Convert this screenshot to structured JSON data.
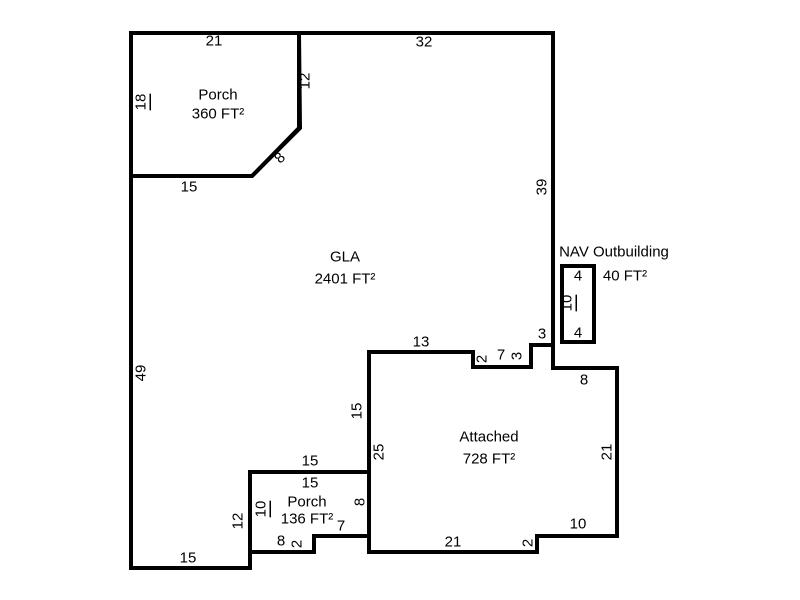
{
  "sketch": {
    "width": 800,
    "height": 600,
    "background_color": "#ffffff",
    "wall_color": "#000000",
    "wall_stroke_width": 4,
    "dim_font_size": 15,
    "area_font_size": 15,
    "scale_px_per_ft": 8,
    "shapes": [
      {
        "name": "gla-outline",
        "points": [
          [
            299,
            33
          ],
          [
            553,
            33
          ],
          [
            553,
            345
          ],
          [
            531,
            345
          ],
          [
            531,
            367
          ],
          [
            473,
            367
          ],
          [
            473,
            352
          ],
          [
            369,
            352
          ],
          [
            369,
            472
          ],
          [
            250,
            472
          ],
          [
            250,
            568
          ],
          [
            131,
            568
          ],
          [
            131,
            176
          ],
          [
            252,
            176
          ],
          [
            300,
            128
          ]
        ]
      },
      {
        "name": "porch-top-outline",
        "points": [
          [
            131,
            33
          ],
          [
            299,
            33
          ],
          [
            299,
            128
          ],
          [
            252,
            176
          ],
          [
            131,
            176
          ]
        ]
      },
      {
        "name": "attached-outline",
        "points": [
          [
            369,
            352
          ],
          [
            473,
            352
          ],
          [
            473,
            367
          ],
          [
            531,
            367
          ],
          [
            531,
            345
          ],
          [
            553,
            345
          ],
          [
            553,
            368
          ],
          [
            617,
            368
          ],
          [
            617,
            536
          ],
          [
            537,
            536
          ],
          [
            537,
            552
          ],
          [
            369,
            552
          ]
        ]
      },
      {
        "name": "porch-bottom-outline",
        "points": [
          [
            250,
            472
          ],
          [
            369,
            472
          ],
          [
            369,
            536
          ],
          [
            314,
            536
          ],
          [
            314,
            552
          ],
          [
            250,
            552
          ]
        ]
      },
      {
        "name": "outbuilding-outline",
        "points": [
          [
            562,
            266
          ],
          [
            594,
            266
          ],
          [
            594,
            342
          ],
          [
            562,
            342
          ]
        ]
      }
    ],
    "area_labels": [
      {
        "name": "label-porch-top-name",
        "text": "Porch",
        "x": 218,
        "y": 95
      },
      {
        "name": "label-porch-top-area",
        "text": "360 FT²",
        "x": 218,
        "y": 114
      },
      {
        "name": "label-gla-name",
        "text": "GLA",
        "x": 345,
        "y": 257
      },
      {
        "name": "label-gla-area",
        "text": "2401 FT²",
        "x": 345,
        "y": 279
      },
      {
        "name": "label-outbuilding-name",
        "text": "NAV Outbuilding",
        "x": 614,
        "y": 252
      },
      {
        "name": "label-outbuilding-area",
        "text": "40 FT²",
        "x": 625,
        "y": 276
      },
      {
        "name": "label-attached-name",
        "text": "Attached",
        "x": 489,
        "y": 437
      },
      {
        "name": "label-attached-area",
        "text": "728 FT²",
        "x": 489,
        "y": 459
      },
      {
        "name": "label-porch-bottom-name",
        "text": "Porch",
        "x": 307,
        "y": 502
      },
      {
        "name": "label-porch-bottom-area",
        "text": "136 FT²",
        "x": 307,
        "y": 519
      }
    ],
    "dim_labels": [
      {
        "name": "dim-porch-top-21",
        "text": "21",
        "x": 214,
        "y": 41,
        "rotate": 0,
        "underline": false
      },
      {
        "name": "dim-top-32",
        "text": "32",
        "x": 424,
        "y": 42,
        "rotate": 0,
        "underline": false
      },
      {
        "name": "dim-porch-right-12",
        "text": "12",
        "x": 305,
        "y": 81,
        "rotate": -90,
        "underline": false
      },
      {
        "name": "dim-porch-left-18",
        "text": "18",
        "x": 141,
        "y": 102,
        "rotate": -90,
        "underline": true
      },
      {
        "name": "dim-porch-diagonal-8",
        "text": "8",
        "x": 280,
        "y": 158,
        "rotate": -45,
        "underline": false
      },
      {
        "name": "dim-porch-bottom-15",
        "text": "15",
        "x": 189,
        "y": 187,
        "rotate": 0,
        "underline": false
      },
      {
        "name": "dim-right-39",
        "text": "39",
        "x": 542,
        "y": 187,
        "rotate": -90,
        "underline": false
      },
      {
        "name": "dim-left-49",
        "text": "49",
        "x": 141,
        "y": 373,
        "rotate": -90,
        "underline": false
      },
      {
        "name": "dim-outbuilding-top-4",
        "text": "4",
        "x": 578,
        "y": 276,
        "rotate": 0,
        "underline": false
      },
      {
        "name": "dim-outbuilding-side-10",
        "text": "10",
        "x": 567,
        "y": 303,
        "rotate": -90,
        "underline": true
      },
      {
        "name": "dim-outbuilding-bottom-4",
        "text": "4",
        "x": 578,
        "y": 333,
        "rotate": 0,
        "underline": false
      },
      {
        "name": "dim-gla-notch-3h",
        "text": "3",
        "x": 542,
        "y": 334,
        "rotate": 0,
        "underline": false
      },
      {
        "name": "dim-attached-top-13",
        "text": "13",
        "x": 421,
        "y": 342,
        "rotate": 0,
        "underline": false
      },
      {
        "name": "dim-attached-step-2a",
        "text": "2",
        "x": 482,
        "y": 359,
        "rotate": -90,
        "underline": false
      },
      {
        "name": "dim-attached-notch-7",
        "text": "7",
        "x": 501,
        "y": 355,
        "rotate": 0,
        "underline": false
      },
      {
        "name": "dim-gla-notch-3v",
        "text": "3",
        "x": 517,
        "y": 356,
        "rotate": -90,
        "underline": false
      },
      {
        "name": "dim-attached-top-8",
        "text": "8",
        "x": 584,
        "y": 380,
        "rotate": 0,
        "underline": false
      },
      {
        "name": "dim-gla-side-15",
        "text": "15",
        "x": 357,
        "y": 411,
        "rotate": -90,
        "underline": false
      },
      {
        "name": "dim-attached-left-25",
        "text": "25",
        "x": 379,
        "y": 452,
        "rotate": -90,
        "underline": false
      },
      {
        "name": "dim-attached-right-21",
        "text": "21",
        "x": 607,
        "y": 452,
        "rotate": -90,
        "underline": false
      },
      {
        "name": "dim-gla-bottom-15",
        "text": "15",
        "x": 310,
        "y": 461,
        "rotate": 0,
        "underline": false
      },
      {
        "name": "dim-porch-bottom-top-15",
        "text": "15",
        "x": 310,
        "y": 483,
        "rotate": 0,
        "underline": false
      },
      {
        "name": "dim-porch-bottom-left-10",
        "text": "10",
        "x": 261,
        "y": 509,
        "rotate": -90,
        "underline": true
      },
      {
        "name": "dim-gla-step-12",
        "text": "12",
        "x": 238,
        "y": 521,
        "rotate": -90,
        "underline": false
      },
      {
        "name": "dim-porch-bottom-right-8",
        "text": "8",
        "x": 360,
        "y": 502,
        "rotate": -90,
        "underline": false
      },
      {
        "name": "dim-porch-bottom-notch-7",
        "text": "7",
        "x": 341,
        "y": 526,
        "rotate": 0,
        "underline": false
      },
      {
        "name": "dim-porch-bottom-8",
        "text": "8",
        "x": 281,
        "y": 541,
        "rotate": 0,
        "underline": false
      },
      {
        "name": "dim-porch-bottom-step-2",
        "text": "2",
        "x": 297,
        "y": 544,
        "rotate": -90,
        "underline": false
      },
      {
        "name": "dim-attached-bottom-21",
        "text": "21",
        "x": 453,
        "y": 542,
        "rotate": 0,
        "underline": false
      },
      {
        "name": "dim-attached-step-2b",
        "text": "2",
        "x": 528,
        "y": 543,
        "rotate": -90,
        "underline": false
      },
      {
        "name": "dim-attached-bottom-10",
        "text": "10",
        "x": 578,
        "y": 524,
        "rotate": 0,
        "underline": false
      },
      {
        "name": "dim-gla-bottomleft-15",
        "text": "15",
        "x": 188,
        "y": 558,
        "rotate": 0,
        "underline": false
      }
    ]
  }
}
